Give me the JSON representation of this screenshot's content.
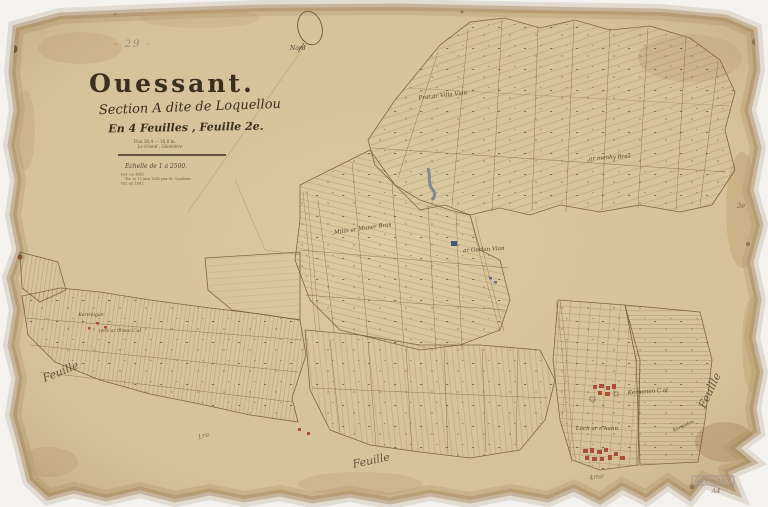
{
  "page": {
    "background": "#f4f3f0"
  },
  "paper": {
    "color": "#d6c39b",
    "edge_color": "#a98b5f"
  },
  "title_block": {
    "pencil_number": "- 29 -",
    "title": "Ouessant.",
    "section_line": "Section A dite de Loquellou",
    "sheets_line": "En 4 Feuilles , Feuille 2e.",
    "dimension_line": "P.on 30,4 — 10,0 m.",
    "surveyor_line": "Le Grand , Géomètre",
    "scale_line": "Echelle de 1 à 2500.",
    "note_line_1": "Lev. en 1841.",
    "note_line_2": "Ter. le 15 juin 1842 par M. Gauthier.",
    "note_line_3": "Ver. en 1842."
  },
  "compass": {
    "label": "Nord"
  },
  "map_labels": [
    {
      "text": "Prat ar Villa Vian"
    },
    {
      "text": "ar menhy Bras"
    },
    {
      "text": "Milin ar Maner Bras"
    },
    {
      "text": "ar Gorlan Vian"
    },
    {
      "text": "Kervinigan"
    },
    {
      "text": "porz ar hraou C.al"
    },
    {
      "text": "Kernonen C.al"
    },
    {
      "text": "Loch ar c'hann"
    },
    {
      "text": "Kergadou"
    }
  ],
  "sheet_labels": {
    "left": "Feuille",
    "bottom": "Feuille",
    "right": "Feuille",
    "ref_left": "1re",
    "ref_bottom": "4me",
    "ref_right": "3e"
  },
  "stamp": {
    "text": "OUESSANT",
    "annotation": "A4"
  },
  "colors": {
    "ink": "#6e5637",
    "text": "#3a2e1f",
    "building_red": "#a8432c",
    "water_blue": "#50617c",
    "stamp": "#8e86a2",
    "pencil": "#9a8f7e"
  }
}
